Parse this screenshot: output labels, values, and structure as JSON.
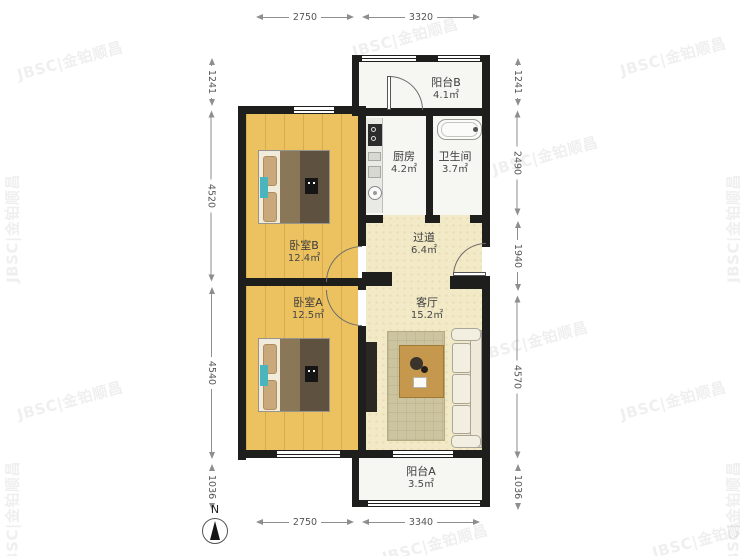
{
  "watermark": {
    "text": "JBSC|金铂顺昌"
  },
  "compass": {
    "north_label": "N"
  },
  "rooms": {
    "balcony_b": {
      "name": "阳台B",
      "area": "4.1㎡"
    },
    "kitchen": {
      "name": "厨房",
      "area": "4.2㎡"
    },
    "bathroom": {
      "name": "卫生间",
      "area": "3.7㎡"
    },
    "bedroom_b": {
      "name": "卧室B",
      "area": "12.4㎡"
    },
    "hallway": {
      "name": "过道",
      "area": "6.4㎡"
    },
    "bedroom_a": {
      "name": "卧室A",
      "area": "12.5㎡"
    },
    "living_room": {
      "name": "客厅",
      "area": "15.2㎡"
    },
    "balcony_a": {
      "name": "阳台A",
      "area": "3.5㎡"
    }
  },
  "dimensions": {
    "top": [
      "2750",
      "3320"
    ],
    "bottom": [
      "2750",
      "3340"
    ],
    "left": [
      "1241",
      "4520",
      "4540",
      "1036"
    ],
    "right": [
      "1241",
      "2490",
      "1940",
      "4570",
      "1036"
    ]
  },
  "colors": {
    "wall": "#1e1e1c",
    "wood_floor": "#ecc261",
    "living_floor": "#f2e9c7",
    "white_floor": "#f6f6f3",
    "teal_accent": "#4ab5bd"
  }
}
